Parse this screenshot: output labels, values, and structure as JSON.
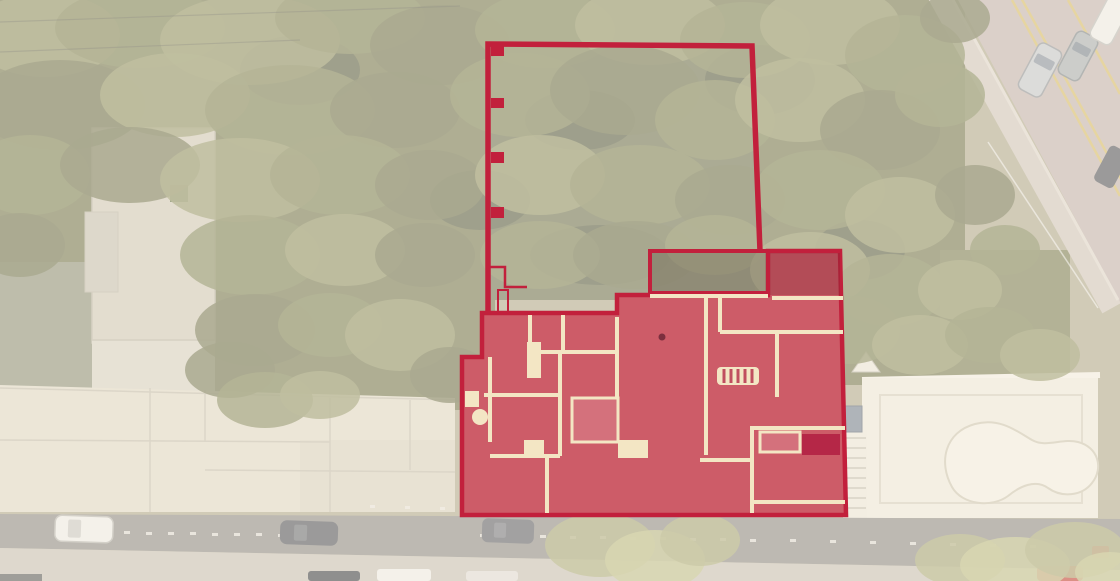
{
  "scene": {
    "kind": "aerial-satellite-photo-with-cadastral-overlay",
    "overlay_elements": {
      "lot_outline": "red outlined rear garden lot with wall tick marks",
      "building_footprint": "red filled ground-floor building plan fronting the street",
      "patio_area": "semi-transparent shaded patio rectangle",
      "stair_symbol": "striped staircase marker inside plan"
    },
    "surroundings": {
      "left": "neighbouring flat roofs and tall narrow building with green skylight",
      "right": "white terrace with kidney-shaped swimming pool and diagonal avenue with traffic",
      "bottom": "street with parked cars and sidewalk",
      "background": "dense tree canopy washed by a light overlay"
    }
  },
  "colors": {
    "plan_outline": "#c2203c",
    "plan_fill": "#cd5c68",
    "plan_fill_dark": "#b52747",
    "plan_fill_mid": "#c04f5f",
    "plan_fill_light": "#d4717c",
    "wall": "#f3e6c4",
    "patio": "rgba(86,74,58,.32)",
    "wash": "rgba(255,250,243,.42)",
    "ground": "#b0a98c",
    "paved_left": "#8f9178",
    "building": "#cfc9b5",
    "building_light": "#d6d0bf",
    "annex": "#c5bfae",
    "roofgreen": "#5d6b42",
    "bigroof": "#ded7c3",
    "bigroof_b": "#d7d0bc",
    "roofseam": "#c3bcaa",
    "terrace": "#ece7d8",
    "terrace_line": "#d5cebb",
    "pool": "#f1ecde",
    "pool_line": "#ccc4ae",
    "steps": "#eae5d6",
    "steps_line": "#c9c3b1",
    "utility": "#76828f",
    "street": "#8e8b84",
    "sidewalk": "#c7c0b2",
    "dash": "#e8e4da",
    "road": "#c2b2ab",
    "road_walk": "#cfc5b8",
    "curb": "#ddd4c8",
    "lane": "#d4bb66",
    "car_silver": "#c3c6c8",
    "car_suv": "#a7adad",
    "car_white": "#eceae4",
    "car_dark": "#53555a",
    "car_red": "#c24436",
    "bin_red": "#c0392f",
    "dot": "#7c2f3e",
    "cable": "rgba(255,255,255,.55)",
    "power": "rgba(70,70,60,.38)",
    "canopy": [
      "#565a40",
      "#6d7049",
      "#7f8254",
      "#939464",
      "#a8a873",
      "#bcbc83"
    ]
  }
}
